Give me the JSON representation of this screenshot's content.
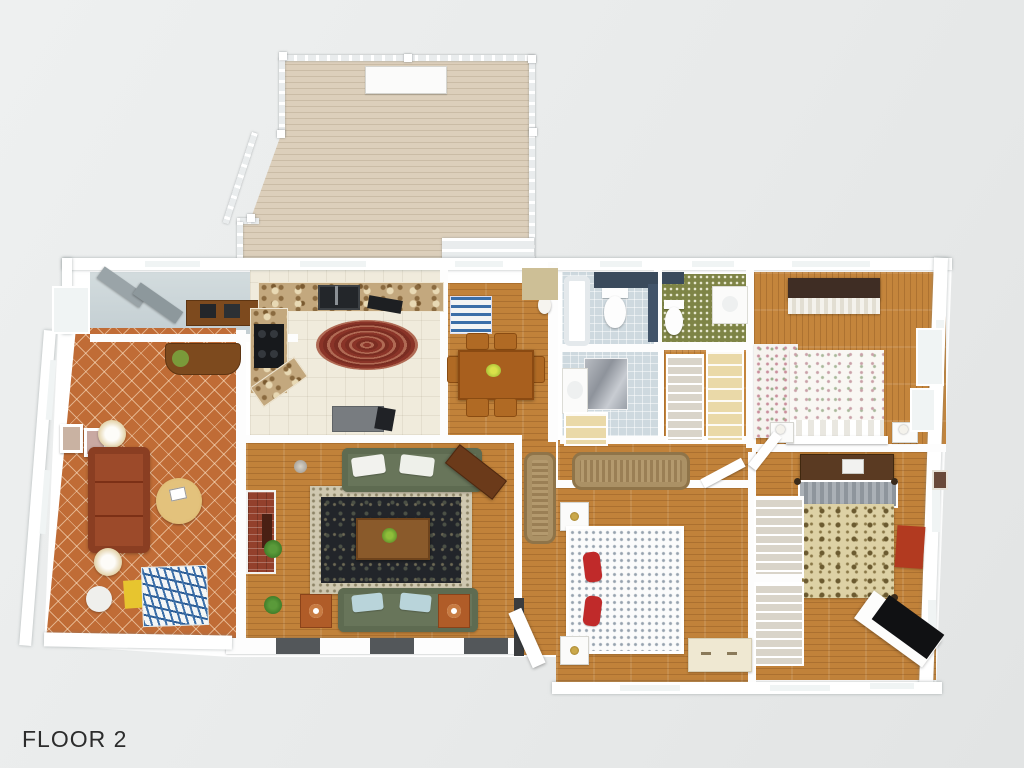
{
  "page": {
    "background_color": "#e8eaea",
    "floor_label": "FLOOR 2"
  },
  "floorplan": {
    "view": "3d-top-down-render",
    "level": "FLOOR 2",
    "rooms": [
      "deck",
      "mudroom",
      "sunroom",
      "kitchen",
      "dining-room",
      "living-room",
      "hallway",
      "master-bathroom",
      "second-bathroom",
      "walk-in-closet",
      "linen-closet",
      "bedroom-top-right",
      "bedroom-middle-right",
      "bedroom-bottom"
    ],
    "furniture": {
      "deck": [
        "railing",
        "bench"
      ],
      "sunroom": [
        "rust-sofa",
        "round-coffee-table",
        "two-lamp-tables",
        "daybed-blue-pattern",
        "yellow-mat",
        "white-side-table",
        "writing-desk",
        "green-chair",
        "wall-pictures"
      ],
      "kitchen": [
        "granite-counters",
        "double-sink",
        "black-range",
        "oval-braided-rug",
        "gray-island"
      ],
      "dining-room": [
        "wood-table",
        "six-chairs",
        "blue-striped-rug",
        "white-vase"
      ],
      "living-room": [
        "two-green-sofas",
        "oriental-rug",
        "coffee-table-with-plant",
        "brick-fireplace",
        "wood-console",
        "two-side-tables",
        "potted-plants"
      ],
      "hallway": [
        "braided-runner-vertical",
        "braided-runner-horizontal"
      ],
      "master-bathroom": [
        "bathtub",
        "toilet",
        "marble-shower",
        "vanity-sink",
        "linen-cabinet"
      ],
      "second-bathroom": [
        "toilet",
        "white-vanity",
        "green-wallpaper"
      ],
      "bedroom-top-right": [
        "floral-bed",
        "floral-rug",
        "dark-dresser",
        "two-nightstands"
      ],
      "bedroom-middle-right": [
        "tan-floral-bed",
        "dark-desk-dresser",
        "red-rug",
        "black-top-desk"
      ],
      "bedroom-bottom": [
        "dotted-bed-red-pillows",
        "two-nightstands",
        "cream-dresser",
        "wire-closets"
      ]
    },
    "palette": {
      "wall": "#ffffff",
      "wood_floor": "#c1823a",
      "terracotta_tile": "#c06c36",
      "kitchen_tile": "#f0ebdc",
      "bath_tile": "#ced9df",
      "deck_plank": "#dccfbb",
      "rug_field": "#22252a",
      "rug_border": "#cfc8b0",
      "sofa_green": "#68755a",
      "sofa_rust": "#9c4a2a",
      "accent_navy": "#3a4a5c",
      "accent_olive": "#7e8446",
      "red_rug": "#b23a20",
      "yellow_mat": "#e7c52f",
      "daybed_blue": "#3a6ea8"
    }
  }
}
